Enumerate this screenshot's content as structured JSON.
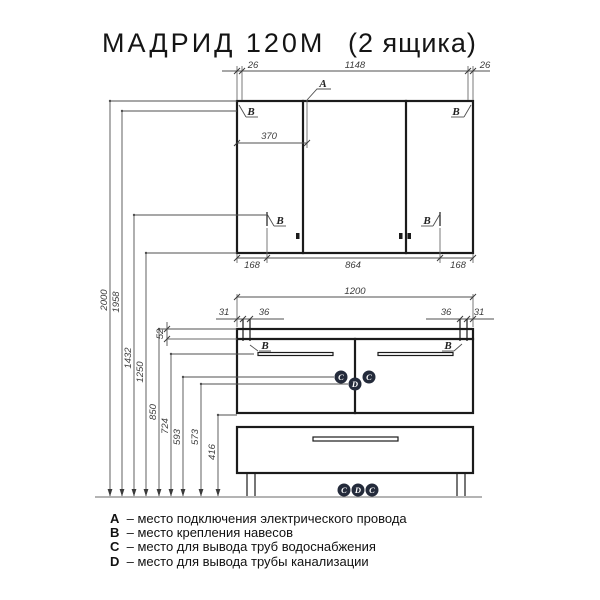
{
  "title": {
    "model": "МАДРИД 120М",
    "variant": "(2 ящика)"
  },
  "legend": [
    {
      "key": "A",
      "text": "– место подключения электрического провода"
    },
    {
      "key": "B",
      "text": "– место крепления навесов"
    },
    {
      "key": "C",
      "text": "– место для вывода труб водоснабжения"
    },
    {
      "key": "D",
      "text": "– место для вывода трубы канализации"
    }
  ],
  "markers": {
    "a": "A",
    "b": "B",
    "c": "C",
    "d": "D"
  },
  "dims": {
    "top": [
      "26",
      "1148",
      "26"
    ],
    "upper_door_width": "370",
    "upper_bottom": [
      "168",
      "864",
      "168"
    ],
    "lower_width": "1200",
    "lower_hinges_left": [
      "31",
      "36"
    ],
    "lower_hinges_right": [
      "36",
      "31"
    ],
    "countertop_thickness": "52",
    "heights": [
      "2000",
      "1958",
      "1432",
      "1250",
      "850",
      "724",
      "593",
      "573",
      "416"
    ]
  },
  "colors": {
    "marker_fill": "#242b3b",
    "marker_text": "#ffffff",
    "line": "#1b1b1b"
  }
}
